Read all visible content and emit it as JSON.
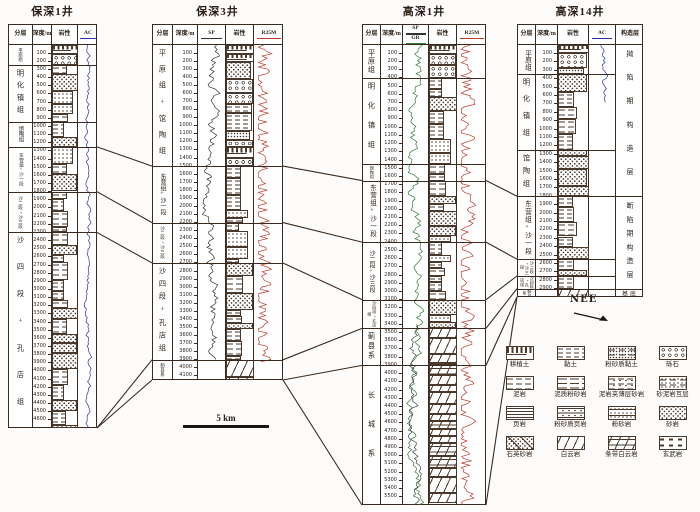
{
  "figure": {
    "scale_bar_label": "5 km",
    "direction_label": "NEE",
    "colors": {
      "line_art": "#3b2a20",
      "ac_curve": "#2b35a8",
      "sp_curve": "#333333",
      "gr_curve": "#2e7d32",
      "resistivity_curve": "#c0392b"
    }
  },
  "wells": [
    {
      "name": "保深1井",
      "depth_unit": "m",
      "depth_max": 4700,
      "depth_tick_step": 100,
      "columns": [
        {
          "type": "strat",
          "label": "分层"
        },
        {
          "type": "depth",
          "label": "深度/m"
        },
        {
          "type": "lith",
          "label": "岩性"
        },
        {
          "type": "curve",
          "label": "AC",
          "underline": "#2b35a8"
        }
      ],
      "curves": [
        {
          "col": 3,
          "style": "ac",
          "color": "#2b35a8",
          "from": 0,
          "to": 4700
        }
      ],
      "formations": [
        {
          "name": "平原组",
          "top": 0,
          "bottom": 250,
          "lith": "surface"
        },
        {
          "name": "明化镇组",
          "top": 250,
          "bottom": 950,
          "lith": "clastic"
        },
        {
          "name": "馆陶组",
          "top": 950,
          "bottom": 1250,
          "lith": "clastic"
        },
        {
          "name": "东营组+沙一段",
          "top": 1250,
          "bottom": 1800,
          "lith": "clastic"
        },
        {
          "name": "沙二段+沙三段",
          "top": 1800,
          "bottom": 2300,
          "lith": "clastic"
        },
        {
          "name": "沙四段+孔店组",
          "top": 2300,
          "bottom": 4700,
          "lith": "clastic"
        }
      ]
    },
    {
      "name": "保深3井",
      "depth_unit": "m",
      "depth_max": 4150,
      "depth_tick_step": 100,
      "columns": [
        {
          "type": "strat",
          "label": "分层"
        },
        {
          "type": "depth",
          "label": "深度/m"
        },
        {
          "type": "curve",
          "label": "SP",
          "underline": "#333333"
        },
        {
          "type": "lith",
          "label": "岩性"
        },
        {
          "type": "curve",
          "label": "R25M",
          "underline": "#c0392b"
        }
      ],
      "curves": [
        {
          "col": 2,
          "style": "sp",
          "color": "#333333",
          "from": 0,
          "to": 3900
        },
        {
          "col": 4,
          "style": "res",
          "color": "#c0392b",
          "from": 0,
          "to": 3950
        }
      ],
      "formations": [
        {
          "name": "平原组+馆陶组",
          "top": 0,
          "bottom": 1500,
          "lith": "surface"
        },
        {
          "name": "东营组+沙一段",
          "top": 1500,
          "bottom": 2200,
          "lith": "clastic"
        },
        {
          "name": "沙二段+沙三段",
          "top": 2200,
          "bottom": 2700,
          "lith": "clastic"
        },
        {
          "name": "沙四段+孔店组",
          "top": 2700,
          "bottom": 3900,
          "lith": "clastic"
        },
        {
          "name": "蓟县系",
          "top": 3900,
          "bottom": 4150,
          "lith": "carbonate"
        }
      ]
    },
    {
      "name": "高深1井",
      "depth_unit": "m",
      "depth_max": 5600,
      "depth_tick_step": 100,
      "columns": [
        {
          "type": "strat",
          "label": "分层"
        },
        {
          "type": "depth",
          "label": "深度/m"
        },
        {
          "type": "curve",
          "label": "SP",
          "underline": "#333333",
          "label2": "GR",
          "underline2": "#2e7d32"
        },
        {
          "type": "lith",
          "label": "岩性"
        },
        {
          "type": "curve",
          "label": "R25M",
          "underline": "#c0392b"
        }
      ],
      "curves": [
        {
          "col": 2,
          "style": "sp",
          "color": "#2e7d32",
          "from": 0,
          "to": 5600
        },
        {
          "col": 2,
          "style": "sp",
          "color": "#444444",
          "from": 3400,
          "to": 5600
        },
        {
          "col": 4,
          "style": "res",
          "color": "#c0392b",
          "from": 0,
          "to": 5600
        }
      ],
      "formations": [
        {
          "name": "平原组",
          "top": 0,
          "bottom": 400,
          "lith": "surface"
        },
        {
          "name": "明化镇组",
          "top": 400,
          "bottom": 1450,
          "lith": "clastic"
        },
        {
          "name": "馆陶组",
          "top": 1450,
          "bottom": 1650,
          "lith": "clastic"
        },
        {
          "name": "东营组+沙一段",
          "top": 1650,
          "bottom": 2400,
          "lith": "clastic"
        },
        {
          "name": "沙二段+沙三段",
          "top": 2400,
          "bottom": 3100,
          "lith": "clastic"
        },
        {
          "name": "沙四段+孔店组",
          "top": 3100,
          "bottom": 3450,
          "lith": "clastic"
        },
        {
          "name": "蓟县系",
          "top": 3450,
          "bottom": 3900,
          "lith": "carbonate"
        },
        {
          "name": "长城系",
          "top": 3900,
          "bottom": 5600,
          "lith": "carbonate"
        }
      ]
    },
    {
      "name": "高深14井",
      "depth_unit": "m",
      "depth_max": 3000,
      "depth_tick_step": 100,
      "columns": [
        {
          "type": "strat",
          "label": "分层"
        },
        {
          "type": "depth",
          "label": "深度/m"
        },
        {
          "type": "lith",
          "label": "岩性"
        },
        {
          "type": "curve",
          "label": "AC",
          "underline": "#2b35a8"
        },
        {
          "type": "tect",
          "label": "构造层"
        }
      ],
      "curves": [
        {
          "col": 3,
          "style": "ac",
          "color": "#2b35a8",
          "from": 0,
          "to": 700
        }
      ],
      "formations": [
        {
          "name": "平原组",
          "top": 0,
          "bottom": 350,
          "lith": "surface"
        },
        {
          "name": "明化镇组",
          "top": 350,
          "bottom": 1250,
          "lith": "clastic"
        },
        {
          "name": "馆陶组",
          "top": 1250,
          "bottom": 1800,
          "lith": "clastic"
        },
        {
          "name": "东营组+沙一段",
          "top": 1800,
          "bottom": 2550,
          "lith": "clastic"
        },
        {
          "name": "沙二段+沙三段",
          "top": 2550,
          "bottom": 2750,
          "lith": "clastic"
        },
        {
          "name": "沙四段+孔店组",
          "top": 2750,
          "bottom": 2900,
          "lith": "clastic"
        },
        {
          "name": "蓟县系",
          "top": 2900,
          "bottom": 3000,
          "lith": "carbonate"
        }
      ],
      "tectonic_units": [
        {
          "name": "拗陷期构造层",
          "top": 0,
          "bottom": 1800
        },
        {
          "name": "断陷期构造层",
          "top": 1800,
          "bottom": 2900
        },
        {
          "name": "基底",
          "top": 2900,
          "bottom": 3000
        }
      ]
    }
  ],
  "correlations": [
    {
      "from_well": 0,
      "from_depth": 1250,
      "to_well": 1,
      "to_depth": 1500
    },
    {
      "from_well": 0,
      "from_depth": 1800,
      "to_well": 1,
      "to_depth": 2200
    },
    {
      "from_well": 0,
      "from_depth": 2300,
      "to_well": 1,
      "to_depth": 2700
    },
    {
      "from_well": 0,
      "from_depth": 4700,
      "to_well": 1,
      "to_depth": 3900
    },
    {
      "from_well": 0,
      "from_depth": 4700,
      "to_well": 1,
      "to_depth": 4150
    },
    {
      "from_well": 1,
      "from_depth": 1500,
      "to_well": 2,
      "to_depth": 1650
    },
    {
      "from_well": 1,
      "from_depth": 2200,
      "to_well": 2,
      "to_depth": 2400
    },
    {
      "from_well": 1,
      "from_depth": 2700,
      "to_well": 2,
      "to_depth": 3100
    },
    {
      "from_well": 1,
      "from_depth": 3900,
      "to_well": 2,
      "to_depth": 3450
    },
    {
      "from_well": 1,
      "from_depth": 4150,
      "to_well": 2,
      "to_depth": 3900
    },
    {
      "from_well": 1,
      "from_depth": 4150,
      "to_well": 2,
      "to_depth": 5600
    },
    {
      "from_well": 2,
      "from_depth": 1650,
      "to_well": 3,
      "to_depth": 1800
    },
    {
      "from_well": 2,
      "from_depth": 2400,
      "to_well": 3,
      "to_depth": 2550
    },
    {
      "from_well": 2,
      "from_depth": 3100,
      "to_well": 3,
      "to_depth": 2750
    },
    {
      "from_well": 2,
      "from_depth": 3450,
      "to_well": 3,
      "to_depth": 2900
    },
    {
      "from_well": 2,
      "from_depth": 3900,
      "to_well": 3,
      "to_depth": 3000
    },
    {
      "from_well": 2,
      "from_depth": 5600,
      "to_well": 3,
      "to_depth": 3000
    }
  ],
  "legend": {
    "items": [
      {
        "label": "耕植土",
        "pattern": "topsoil"
      },
      {
        "label": "黏土",
        "pattern": "clay"
      },
      {
        "label": "粉砂质黏土",
        "pattern": "silty-clay"
      },
      {
        "label": "砾石",
        "pattern": "gravel"
      },
      {
        "label": "泥岩",
        "pattern": "mudstone"
      },
      {
        "label": "泥质粉砂岩",
        "pattern": "muddy-siltstone"
      },
      {
        "label": "泥岩夹薄层砂岩",
        "pattern": "mud-thin-sand"
      },
      {
        "label": "砂泥岩互层",
        "pattern": "sand-mud-interbed"
      },
      {
        "label": "页岩",
        "pattern": "shale"
      },
      {
        "label": "粉砂质页岩",
        "pattern": "silty-shale"
      },
      {
        "label": "粉砂岩",
        "pattern": "siltstone"
      },
      {
        "label": "砂岩",
        "pattern": "sandstone"
      },
      {
        "label": "石英砂岩",
        "pattern": "quartz-sandstone"
      },
      {
        "label": "白云岩",
        "pattern": "dolomite"
      },
      {
        "label": "条带白云岩",
        "pattern": "banded-dolomite"
      },
      {
        "label": "玄武岩",
        "pattern": "basalt"
      }
    ]
  }
}
